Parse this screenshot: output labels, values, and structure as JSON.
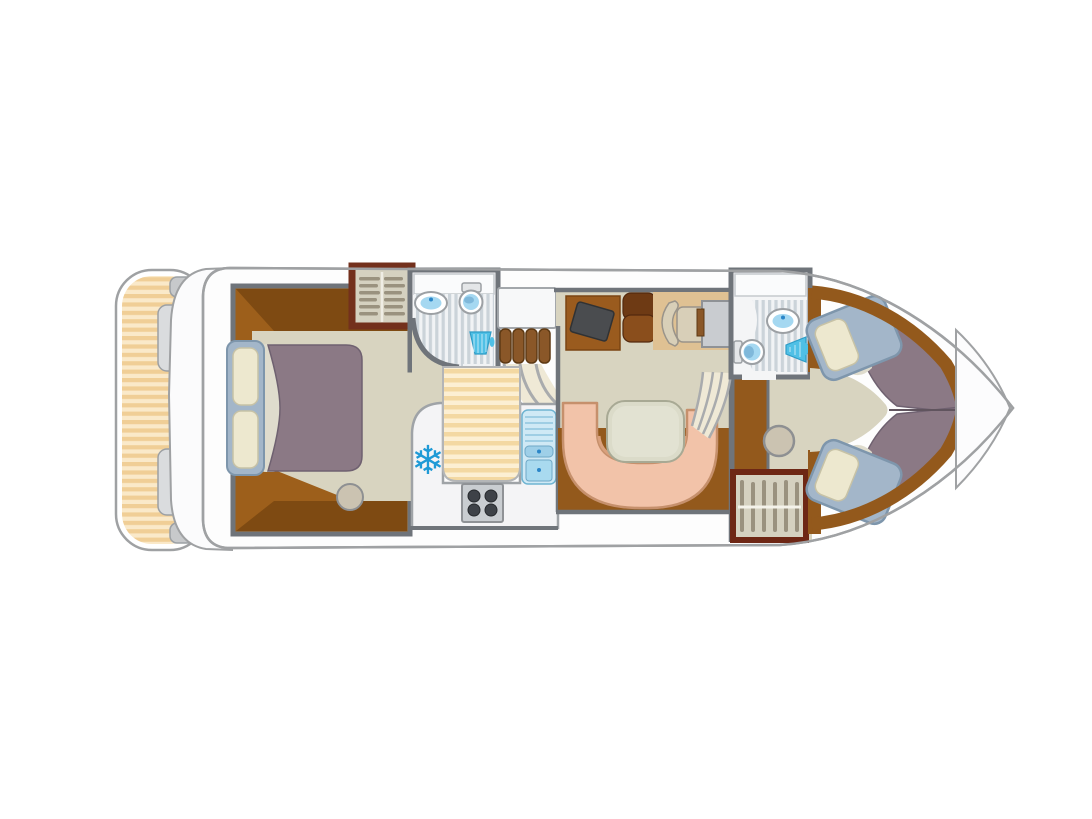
{
  "diagram": {
    "type": "boat-floor-plan",
    "subject": "river cruiser / houseboat interior layout, top view, bow pointing right",
    "rooms": [
      {
        "name": "stern-deck",
        "features": [
          "striped-plank-deck",
          "swim-platform",
          "boarding-steps"
        ]
      },
      {
        "name": "master-cabin-aft",
        "features": [
          "double-bed",
          "two-pillows",
          "duvet",
          "stool",
          "carpet"
        ]
      },
      {
        "name": "wardrobe-aft",
        "features": [
          "clothes-rail",
          "hangers"
        ]
      },
      {
        "name": "bathroom-aft",
        "features": [
          "washbasin",
          "toilet",
          "shower",
          "curved-shower-wall"
        ]
      },
      {
        "name": "galley",
        "features": [
          "refrigerator",
          "four-burner-stove",
          "sink-with-drainer",
          "striped-floor-runner",
          "companionway-steps",
          "handrails"
        ]
      },
      {
        "name": "saloon",
        "features": [
          "tv-on-cabinet",
          "seat-cushions",
          "helm-seat",
          "helm-console"
        ]
      },
      {
        "name": "dinette",
        "features": [
          "u-shaped-sofa",
          "table"
        ]
      },
      {
        "name": "bathroom-fore",
        "features": [
          "washbasin",
          "toilet",
          "shower"
        ]
      },
      {
        "name": "corridor-fore",
        "features": [
          "steps-to-bow",
          "stool",
          "wood-floor-patch"
        ]
      },
      {
        "name": "wardrobe-fore",
        "features": [
          "clothes-rail",
          "hangers"
        ]
      },
      {
        "name": "bow-cabin",
        "features": [
          "single-bed-port",
          "single-bed-starboard",
          "v-berth-duvets"
        ]
      },
      {
        "name": "bow-tip",
        "features": [
          "foredeck"
        ]
      }
    ],
    "icons": {
      "fridge": "snowflake-icon",
      "stove": "four-burner-stove-icon",
      "sink": "sink-faucet-icon",
      "basin": "washbasin-icon",
      "toilet": "toilet-icon",
      "shower": "shower-head-icon",
      "wardrobe": "clothes-hanger-icon"
    },
    "fridge_glyph": "❄"
  },
  "colors": {
    "hull_fill": "#FDFDFD",
    "hull_stroke": "#9FA1A3",
    "wall": "#6F747A",
    "platform_fill": "#FBFBFC",
    "platform_tab": "#C7C9CB",
    "platform_step": "#DADCDE",
    "deck_stripe_light": "#FAE9C9",
    "deck_stripe_dark": "#F0CE96",
    "wood": "#9D5F1B",
    "wood_dark": "#7E4A12",
    "wood_mid": "#93591C",
    "frame_red_aft": "#73301C",
    "frame_red_fore": "#6E2715",
    "carpet": "#D8D4C0",
    "corridor_stripe_light": "#FCEFD3",
    "corridor_stripe_dark": "#F3D8A2",
    "bath_floor_light": "#F1F3F5",
    "bath_floor_dark": "#CBD3D9",
    "bath_room_fill": "#F4F5F6",
    "counter_white": "#F4F4F6",
    "fixture_stroke": "#9CA0A4",
    "water_blue": "#A5D8F1",
    "water_deep": "#7FB8DA",
    "shower_blue": "#4FC0E6",
    "accent_blue": "#2B86C8",
    "snowflake_blue": "#1F9AD6",
    "sink_panel": "#CFE9F5",
    "sink_panel_stroke": "#6FB4D2",
    "sink_item": "#A9DAEF",
    "stove_gray": "#C9CDD1",
    "burner_dark": "#3E4248",
    "bench_fill": "#F2C3A9",
    "bench_stroke": "#C6906C",
    "bench_shadow": "#D9A07C",
    "table_fill": "#DBDBC9",
    "table_stroke": "#A8A994",
    "table_inner": "#E2E2D2",
    "bed_frame": "#A3B6C9",
    "bed_frame_stroke": "#7E96AC",
    "pillow": "#EDE8CF",
    "pillow_stroke": "#C7C2A6",
    "duvet": "#8B7985",
    "duvet_stroke": "#6F6170",
    "duvet_divider": "#60545E",
    "sheet": "#DFDCCD",
    "tv_dark": "#4A4C4F",
    "tv_cabinet": "#9A5B1E",
    "cushion_dark": "#6E3A14",
    "cushion_mid": "#8A4E1C",
    "mat_tan": "#DFC193",
    "chair_beige": "#D8CFB8",
    "chair_stroke": "#9A948A",
    "console_gray": "#C9CCD0",
    "hanger": "#9A927F",
    "wardrobe_interior": "#D5D1C0",
    "stool_fill": "#CBC3B1",
    "stool_stroke": "#8E9092",
    "step_brown": "#8A5728",
    "step_brown_stroke": "#5E3A14",
    "rail_gray": "#A9ABAD",
    "landing_fill": "#F7F8F9",
    "steps_patch": "#EFE9D6"
  }
}
